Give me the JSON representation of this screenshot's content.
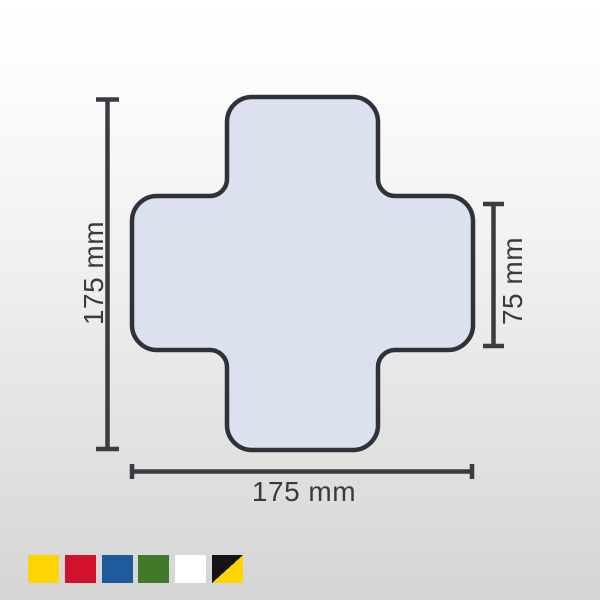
{
  "diagram": {
    "shape": "rounded-cross",
    "fill": "#dbe1ef",
    "stroke": "#2f3238",
    "line_color": "#3a3c42",
    "text_color": "#3a3a3e",
    "dimensions": {
      "height_label": "175 mm",
      "width_label": "175 mm",
      "arm_label": "75 mm"
    }
  },
  "swatches": {
    "items": [
      {
        "name": "yellow",
        "color": "#fcd502",
        "style": "background:#fcd502"
      },
      {
        "name": "red",
        "color": "#d2112a",
        "style": "background:#d2112a"
      },
      {
        "name": "blue",
        "color": "#1e5a9c",
        "style": "background:#1e5a9c"
      },
      {
        "name": "green",
        "color": "#40792a",
        "style": "background:#40792a"
      },
      {
        "name": "white",
        "color": "#ffffff",
        "style": "background:#ffffff"
      },
      {
        "name": "black-yellow",
        "color": "#141417",
        "color2": "#fcd502",
        "style": "background:linear-gradient(to bottom right,#141417 0 50%,#fcd502 50% 100%)"
      }
    ]
  }
}
